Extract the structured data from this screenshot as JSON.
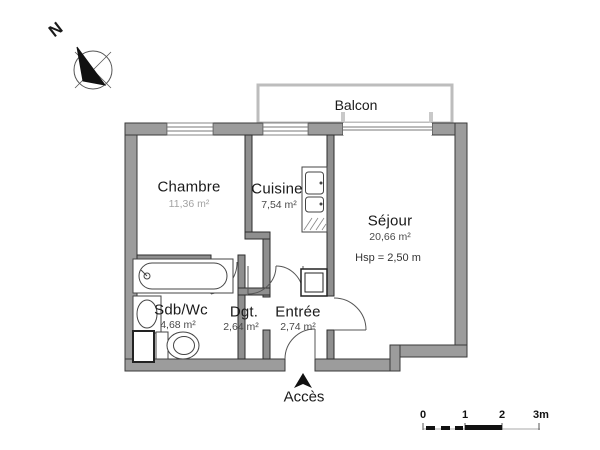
{
  "plan": {
    "rooms": [
      {
        "name": "Chambre",
        "area": "11,36 m²"
      },
      {
        "name": "Cuisine",
        "area": "7,54 m²"
      },
      {
        "name": "Séjour",
        "area": "20,66 m²",
        "note": "Hsp = 2,50 m"
      },
      {
        "name": "Sdb/Wc",
        "area": "4,68 m²"
      },
      {
        "name": "Dgt.",
        "area": "2,64 m²"
      },
      {
        "name": "Entrée",
        "area": "2,74 m²"
      }
    ],
    "balcony_label": "Balcon",
    "access_label": "Accès",
    "compass_label": "N"
  },
  "scale_bar": {
    "labels": [
      "0",
      "1",
      "2",
      "3m"
    ]
  },
  "colors": {
    "wall-fill": "#9c9c9c",
    "wall-stroke": "#3a3a3a",
    "thin-line": "#555555",
    "text": "#1a1a1a",
    "area-text": "#4a4a4a",
    "faded-area-text": "#a3a3a3",
    "rail": "#bdbdbd"
  }
}
